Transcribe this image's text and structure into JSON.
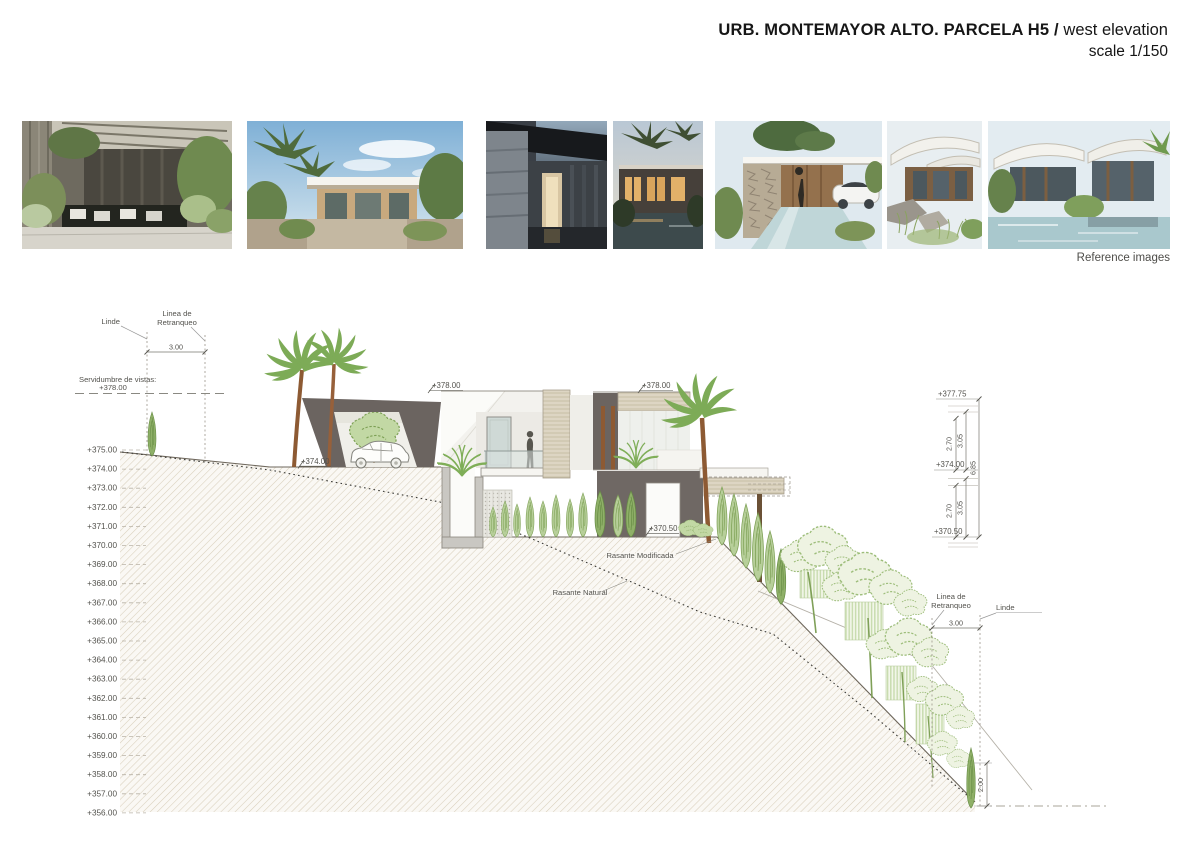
{
  "header": {
    "title_bold": "URB. MONTEMAYOR ALTO. PARCELA H5 /",
    "title_regular": " west elevation",
    "scale_label": "scale 1/150"
  },
  "reference_strip": {
    "caption": "Reference images",
    "images": [
      {
        "name": "courtyard-pergola-pool"
      },
      {
        "name": "white-pavilion-palms-sky"
      },
      {
        "name": "dark-stone-entrance"
      },
      {
        "name": "dusk-house-palms-pool"
      },
      {
        "name": "stone-wall-pool-white-car"
      },
      {
        "name": "curved-roof-landscape-steps"
      },
      {
        "name": "curved-roof-villa-pool"
      }
    ]
  },
  "drawing": {
    "levels": [
      "+375.00",
      "+374.00",
      "+373.00",
      "+372.00",
      "+371.00",
      "+370.00",
      "+369.00",
      "+368.00",
      "+367.00",
      "+366.00",
      "+365.00",
      "+364.00",
      "+363.00",
      "+362.00",
      "+361.00",
      "+360.00",
      "+359.00",
      "+358.00",
      "+357.00",
      "+356.00"
    ],
    "left_boundary": {
      "linde": "Linde",
      "retranqueo_line1": "Linea de",
      "retranqueo_line2": "Retranqueo",
      "setback": "3.00"
    },
    "servidumbre": {
      "line1": "Servidumbre de vistas:",
      "line2": "+378.00"
    },
    "spot_levels": {
      "roof_left": "+378.00",
      "roof_right": "+378.00",
      "carport_floor": "+374.00",
      "lower_floor": "+370.50"
    },
    "right_dims": {
      "top": "+377.75",
      "main_floor": "+374.00",
      "lower_floor": "+370.50",
      "clear_upper": "2.70",
      "floor_upper": "3.05",
      "clear_lower": "2.70",
      "floor_lower": "3.05",
      "total": "6.85",
      "hedge_height": "2.00"
    },
    "right_boundary": {
      "linde": "Linde",
      "retranqueo_line1": "Linea de",
      "retranqueo_line2": "Retranqueo",
      "setback": "3.00"
    },
    "grades": {
      "modified": "Rasante Modificada",
      "natural": "Rasante Natural"
    }
  }
}
